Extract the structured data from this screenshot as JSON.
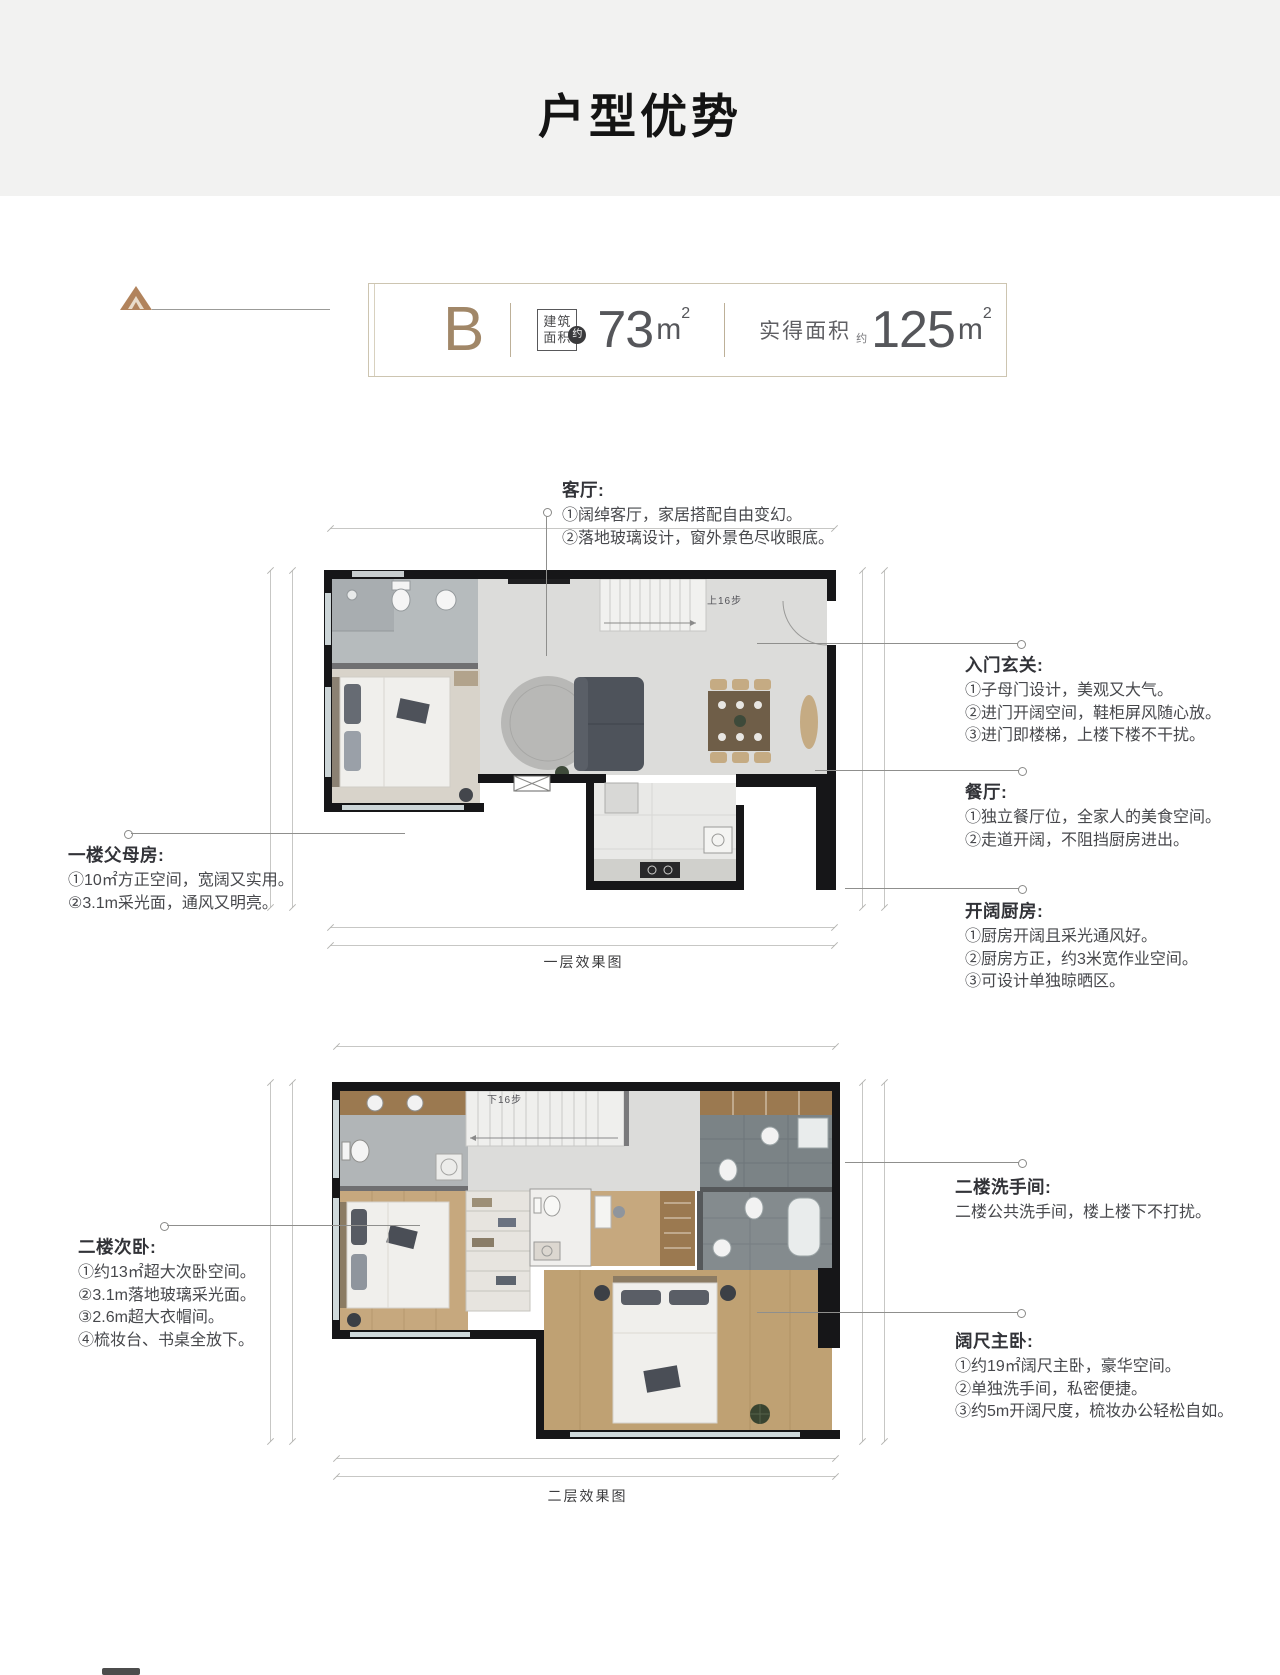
{
  "header": {
    "title": "户型优势"
  },
  "badge": {
    "letter": "B",
    "built_label_1": "建筑",
    "built_label_2": "面积",
    "built_approx": "约",
    "built_value": "73",
    "built_unit": "m",
    "built_sup": "2",
    "actual_label": "实得面积",
    "actual_approx": "约",
    "actual_value": "125",
    "actual_unit": "m",
    "actual_sup": "2"
  },
  "floor1": {
    "caption": "一层效果图",
    "stairs_label": "上16步",
    "annotations": {
      "living": {
        "title": "客厅:",
        "lines": [
          "①阔绰客厅，家居搭配自由变幻。",
          "②落地玻璃设计，窗外景色尽收眼底。"
        ]
      },
      "entry": {
        "title": "入门玄关:",
        "lines": [
          "①子母门设计，美观又大气。",
          "②进门开阔空间，鞋柜屏风随心放。",
          "③进门即楼梯，上楼下楼不干扰。"
        ]
      },
      "dining": {
        "title": "餐厅:",
        "lines": [
          "①独立餐厅位，全家人的美食空间。",
          "②走道开阔，不阻挡厨房进出。"
        ]
      },
      "kitchen": {
        "title": "开阔厨房:",
        "lines": [
          "①厨房开阔且采光通风好。",
          "②厨房方正，约3米宽作业空间。",
          "③可设计单独晾晒区。"
        ]
      },
      "parents": {
        "title": "一楼父母房:",
        "lines": [
          "①10㎡方正空间，宽阔又实用。",
          "②3.1m采光面，通风又明亮。"
        ]
      }
    }
  },
  "floor2": {
    "caption": "二层效果图",
    "stairs_label": "下16步",
    "annotations": {
      "second_bedroom": {
        "title": "二楼次卧:",
        "lines": [
          "①约13㎡超大次卧空间。",
          "②3.1m落地玻璃采光面。",
          "③2.6m超大衣帽间。",
          "④梳妆台、书桌全放下。"
        ]
      },
      "bathroom": {
        "title": "二楼洗手间:",
        "lines": [
          "二楼公共洗手间，楼上楼下不打扰。"
        ]
      },
      "master": {
        "title": "阔尺主卧:",
        "lines": [
          "①约19㎡阔尺主卧，豪华空间。",
          "②单独洗手间，私密便捷。",
          "③约5m开阔尺度，梳妆办公轻松自如。"
        ]
      }
    }
  },
  "colors": {
    "accent_bronze": "#a18768",
    "wall_black": "#161618",
    "tile_gray": "#b6bbbd",
    "wood": "#c6a87e"
  }
}
